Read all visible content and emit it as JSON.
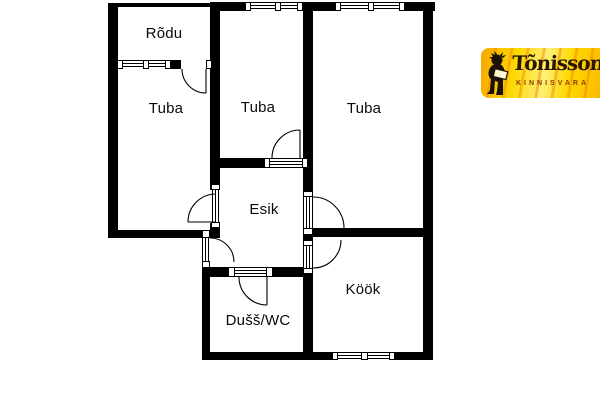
{
  "floorplan": {
    "background": "#ffffff",
    "wall_color": "#000000",
    "rooms": [
      {
        "name": "rodu",
        "label": "Rõdu"
      },
      {
        "name": "tuba-left",
        "label": "Tuba"
      },
      {
        "name": "tuba-middle",
        "label": "Tuba"
      },
      {
        "name": "tuba-right",
        "label": "Tuba"
      },
      {
        "name": "esik",
        "label": "Esik"
      },
      {
        "name": "dush-wc",
        "label": "Dušš/WC"
      },
      {
        "name": "kook",
        "label": "Köök"
      }
    ]
  },
  "logo": {
    "brand": "Tõnisson",
    "tagline": "KINNISVARA",
    "bg_yellow": "#ffd800",
    "accent_orange": "#f08c00",
    "brand_text_color": "#2a1803",
    "tagline_color": "#8a3c00",
    "mascot": "mascot-figure-icon"
  }
}
